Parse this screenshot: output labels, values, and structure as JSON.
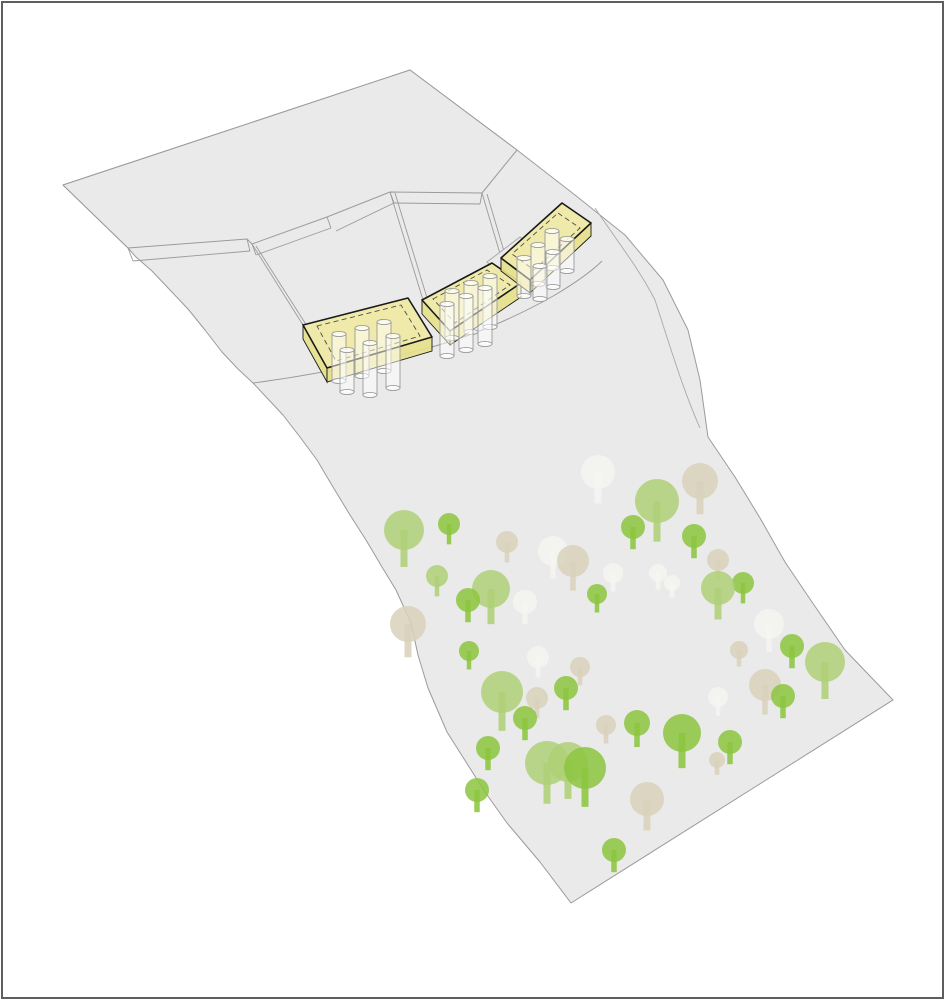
{
  "meta": {
    "diagram_type": "site-axonometric-diagram",
    "content": "terraced terrain sheet with three pile-supported building volumes and tree field on lower slope"
  },
  "canvas": {
    "width": 945,
    "height": 1000,
    "background": "#ffffff"
  },
  "frame": {
    "inset": 2,
    "color": "#5e5e5e",
    "width": 2
  },
  "palette": {
    "terrain_fill": "#ebeaea",
    "terrain_stroke": "#9b9b9b",
    "crease_stroke": "#a8a8a8",
    "building_top": "#efe9a3",
    "building_side": "#e6df8c",
    "building_stroke": "#1a1a1a",
    "dash_stroke": "#4c4c4c",
    "pile_stroke": "#9b9b9b",
    "pile_fill": "rgba(255,255,255,0.5)",
    "pile_cap_fill": "rgba(255,255,255,0.7)",
    "tree_lightgreen": "#afd077",
    "tree_green": "#8cc63f",
    "tree_beige": "#d8d1bb",
    "tree_white": "#f5f4f1"
  },
  "terrain": {
    "silhouette": [
      [
        63,
        185
      ],
      [
        410,
        70
      ],
      [
        517,
        150
      ],
      [
        575,
        195
      ],
      [
        625,
        235
      ],
      [
        663,
        280
      ],
      [
        688,
        330
      ],
      [
        700,
        380
      ],
      [
        708,
        437
      ],
      [
        735,
        477
      ],
      [
        760,
        518
      ],
      [
        785,
        562
      ],
      [
        812,
        602
      ],
      [
        845,
        650
      ],
      [
        893,
        700
      ],
      [
        571,
        903
      ],
      [
        540,
        862
      ],
      [
        507,
        823
      ],
      [
        485,
        792
      ],
      [
        466,
        762
      ],
      [
        447,
        732
      ],
      [
        428,
        688
      ],
      [
        418,
        655
      ],
      [
        411,
        623
      ],
      [
        396,
        590
      ],
      [
        382,
        567
      ],
      [
        366,
        540
      ],
      [
        350,
        515
      ],
      [
        333,
        487
      ],
      [
        317,
        460
      ],
      [
        300,
        437
      ],
      [
        283,
        415
      ],
      [
        268,
        399
      ],
      [
        253,
        383
      ],
      [
        238,
        369
      ],
      [
        222,
        352
      ],
      [
        205,
        330
      ],
      [
        188,
        309
      ],
      [
        170,
        290
      ],
      [
        152,
        271
      ],
      [
        136,
        257
      ],
      [
        128,
        248
      ]
    ],
    "plateau": [
      [
        63,
        185
      ],
      [
        410,
        70
      ],
      [
        517,
        150
      ],
      [
        482,
        193
      ],
      [
        390,
        192
      ],
      [
        327,
        217
      ],
      [
        252,
        244
      ],
      [
        247,
        239
      ],
      [
        128,
        248
      ]
    ],
    "band_lines": [
      [
        [
          128,
          248
        ],
        [
          133,
          261
        ]
      ],
      [
        [
          133,
          261
        ],
        [
          250,
          251
        ]
      ],
      [
        [
          247,
          239
        ],
        [
          250,
          251
        ]
      ],
      [
        [
          252,
          244
        ],
        [
          256,
          255
        ]
      ],
      [
        [
          256,
          255
        ],
        [
          331,
          228
        ]
      ],
      [
        [
          327,
          217
        ],
        [
          331,
          228
        ]
      ],
      [
        [
          336,
          231
        ],
        [
          394,
          203
        ]
      ],
      [
        [
          390,
          192
        ],
        [
          394,
          203
        ]
      ],
      [
        [
          394,
          203
        ],
        [
          480,
          204
        ]
      ],
      [
        [
          480,
          204
        ],
        [
          482,
          193
        ]
      ]
    ],
    "dividers": [
      [
        [
          252,
          244
        ],
        [
          303,
          325
        ]
      ],
      [
        [
          256,
          246
        ],
        [
          307,
          326
        ]
      ],
      [
        [
          390,
          192
        ],
        [
          423,
          300
        ]
      ],
      [
        [
          395,
          193
        ],
        [
          428,
          301
        ]
      ],
      [
        [
          482,
          193
        ],
        [
          501,
          257
        ]
      ],
      [
        [
          487,
          194
        ],
        [
          506,
          258
        ]
      ]
    ],
    "fold_path": "M253,383 C300,377 360,366 420,350 C470,338 520,315 555,295 C575,283 592,271 602,261",
    "crease_path": "M595,208 C615,238 640,270 655,300 C668,340 683,390 700,428",
    "platform_quad": [
      [
        487,
        262
      ],
      [
        520,
        237
      ],
      [
        546,
        259
      ],
      [
        513,
        287
      ]
    ]
  },
  "buildings": [
    {
      "top": [
        [
          303,
          325
        ],
        [
          408,
          298
        ],
        [
          432,
          337
        ],
        [
          327,
          368
        ]
      ],
      "faces": [
        [
          [
            303,
            325
          ],
          [
            327,
            368
          ],
          [
            327,
            382
          ],
          [
            303,
            339
          ]
        ],
        [
          [
            327,
            368
          ],
          [
            432,
            337
          ],
          [
            432,
            351
          ],
          [
            327,
            382
          ]
        ]
      ],
      "dash": [
        [
          317,
          326
        ],
        [
          401,
          305
        ],
        [
          420,
          336
        ],
        [
          336,
          361
        ]
      ],
      "piles": [
        [
          339,
          334,
          381
        ],
        [
          362,
          328,
          376
        ],
        [
          384,
          322,
          371
        ],
        [
          347,
          350,
          392
        ],
        [
          370,
          343,
          395
        ],
        [
          393,
          336,
          388
        ]
      ]
    },
    {
      "top": [
        [
          422,
          300
        ],
        [
          492,
          263
        ],
        [
          521,
          283
        ],
        [
          450,
          331
        ]
      ],
      "faces": [
        [
          [
            422,
            300
          ],
          [
            450,
            331
          ],
          [
            450,
            345
          ],
          [
            422,
            314
          ]
        ],
        [
          [
            450,
            331
          ],
          [
            521,
            283
          ],
          [
            521,
            297
          ],
          [
            450,
            345
          ]
        ]
      ],
      "dash": [
        [
          433,
          299
        ],
        [
          487,
          270
        ],
        [
          510,
          285
        ],
        [
          455,
          323
        ]
      ],
      "piles": [
        [
          452,
          291,
          338
        ],
        [
          471,
          283,
          332
        ],
        [
          490,
          276,
          327
        ],
        [
          447,
          304,
          356
        ],
        [
          466,
          296,
          350
        ],
        [
          485,
          288,
          344
        ]
      ]
    },
    {
      "top": [
        [
          562,
          203
        ],
        [
          591,
          223
        ],
        [
          530,
          280
        ],
        [
          501,
          258
        ]
      ],
      "faces": [
        [
          [
            591,
            223
          ],
          [
            530,
            280
          ],
          [
            530,
            293
          ],
          [
            591,
            236
          ]
        ],
        [
          [
            530,
            280
          ],
          [
            501,
            258
          ],
          [
            501,
            271
          ],
          [
            530,
            293
          ]
        ]
      ],
      "dash": [
        [
          558,
          213
        ],
        [
          580,
          228
        ],
        [
          534,
          270
        ],
        [
          512,
          254
        ]
      ],
      "piles": [
        [
          552,
          231,
          268
        ],
        [
          538,
          245,
          284
        ],
        [
          524,
          258,
          296
        ],
        [
          567,
          239,
          271
        ],
        [
          553,
          252,
          287
        ],
        [
          540,
          266,
          299
        ]
      ]
    }
  ],
  "pile_radius": 7,
  "pile_cap_ry": 2.6,
  "trees": [
    [
      598,
      472,
      17,
      "white"
    ],
    [
      700,
      481,
      18,
      "beige"
    ],
    [
      657,
      501,
      22,
      "lightgreen"
    ],
    [
      404,
      530,
      20,
      "lightgreen"
    ],
    [
      449,
      524,
      11,
      "green"
    ],
    [
      633,
      527,
      12,
      "green"
    ],
    [
      694,
      536,
      12,
      "green"
    ],
    [
      507,
      542,
      11,
      "beige"
    ],
    [
      553,
      551,
      15,
      "white"
    ],
    [
      718,
      560,
      11,
      "beige"
    ],
    [
      573,
      561,
      16,
      "beige"
    ],
    [
      613,
      573,
      10,
      "white"
    ],
    [
      658,
      573,
      9,
      "white"
    ],
    [
      437,
      576,
      11,
      "lightgreen"
    ],
    [
      672,
      583,
      8,
      "white"
    ],
    [
      743,
      583,
      11,
      "green"
    ],
    [
      491,
      589,
      19,
      "lightgreen"
    ],
    [
      718,
      588,
      17,
      "lightgreen"
    ],
    [
      597,
      594,
      10,
      "green"
    ],
    [
      468,
      600,
      12,
      "green"
    ],
    [
      525,
      602,
      12,
      "white"
    ],
    [
      408,
      624,
      18,
      "beige"
    ],
    [
      769,
      624,
      15,
      "white"
    ],
    [
      739,
      650,
      9,
      "beige"
    ],
    [
      792,
      646,
      12,
      "green"
    ],
    [
      469,
      651,
      10,
      "green"
    ],
    [
      538,
      657,
      11,
      "white"
    ],
    [
      825,
      662,
      20,
      "lightgreen"
    ],
    [
      580,
      667,
      10,
      "beige"
    ],
    [
      765,
      685,
      16,
      "beige"
    ],
    [
      566,
      688,
      12,
      "green"
    ],
    [
      502,
      692,
      21,
      "lightgreen"
    ],
    [
      718,
      697,
      10,
      "white"
    ],
    [
      783,
      696,
      12,
      "green"
    ],
    [
      537,
      698,
      11,
      "beige"
    ],
    [
      525,
      718,
      12,
      "green"
    ],
    [
      637,
      723,
      13,
      "green"
    ],
    [
      606,
      725,
      10,
      "beige"
    ],
    [
      682,
      733,
      19,
      "green"
    ],
    [
      730,
      742,
      12,
      "green"
    ],
    [
      488,
      748,
      12,
      "green"
    ],
    [
      547,
      763,
      22,
      "lightgreen"
    ],
    [
      568,
      762,
      20,
      "lightgreen"
    ],
    [
      717,
      760,
      8,
      "beige"
    ],
    [
      585,
      768,
      21,
      "green"
    ],
    [
      477,
      790,
      12,
      "green"
    ],
    [
      647,
      799,
      17,
      "beige"
    ],
    [
      614,
      850,
      12,
      "green"
    ]
  ]
}
